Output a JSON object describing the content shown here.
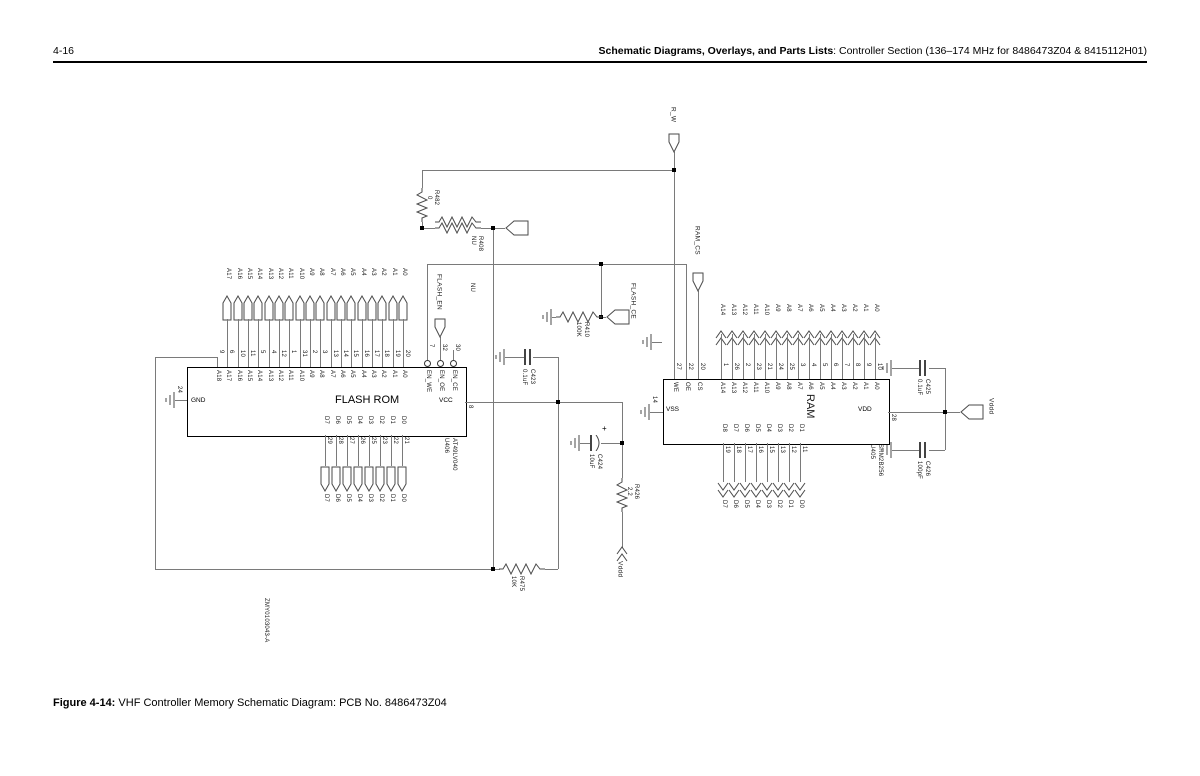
{
  "page": {
    "page_number": "4-16",
    "header_bold": "Schematic Diagrams, Overlays, and Parts Lists",
    "header_rest": ": Controller Section (136–174 MHz for 8486473Z04 & 8415112H01)",
    "figure_bold": "Figure 4-14:",
    "figure_rest": " VHF Controller Memory Schematic Diagram: PCB No. 8486473Z04",
    "drawing_number": "ZMY0103043-A"
  },
  "flash": {
    "name": "FLASH ROM",
    "refdes": "U406",
    "part": "AT49LV040",
    "gnd_label": "GND",
    "gnd_pin": "24",
    "vcc_label": "VCC",
    "vcc_pin": "8",
    "top_pins": [
      {
        "label": "A18",
        "number": "9"
      },
      {
        "label": "A17",
        "number": "6"
      },
      {
        "label": "A16",
        "number": "10"
      },
      {
        "label": "A15",
        "number": "11"
      },
      {
        "label": "A14",
        "number": "5"
      },
      {
        "label": "A13",
        "number": "4"
      },
      {
        "label": "A12",
        "number": "12"
      },
      {
        "label": "A11",
        "number": "1"
      },
      {
        "label": "A10",
        "number": "31"
      },
      {
        "label": "A9",
        "number": "2"
      },
      {
        "label": "A8",
        "number": "3"
      },
      {
        "label": "A7",
        "number": "13"
      },
      {
        "label": "A6",
        "number": "14"
      },
      {
        "label": "A5",
        "number": "15"
      },
      {
        "label": "A4",
        "number": "16"
      },
      {
        "label": "A3",
        "number": "17"
      },
      {
        "label": "A2",
        "number": "18"
      },
      {
        "label": "A1",
        "number": "19"
      },
      {
        "label": "A0",
        "number": "20"
      }
    ],
    "ctrl_pins": [
      {
        "label": "EN_WE",
        "number": "7"
      },
      {
        "label": "EN_OE",
        "number": "32"
      },
      {
        "label": "EN_CE",
        "number": "30"
      }
    ],
    "bottom_pins": [
      {
        "label": "D7",
        "number": "29"
      },
      {
        "label": "D6",
        "number": "28"
      },
      {
        "label": "D5",
        "number": "27"
      },
      {
        "label": "D4",
        "number": "26"
      },
      {
        "label": "D3",
        "number": "25"
      },
      {
        "label": "D2",
        "number": "23"
      },
      {
        "label": "D1",
        "number": "22"
      },
      {
        "label": "D0",
        "number": "21"
      }
    ]
  },
  "ram": {
    "name": "RAM",
    "refdes": "U405",
    "part": "SRM2B256",
    "vss_label": "VSS",
    "vss_pin": "14",
    "vdd_label": "VDD",
    "vdd_pin": "28",
    "top_pins": [
      {
        "label": "WE",
        "number": "27"
      },
      {
        "label": "OE",
        "number": "22"
      },
      {
        "label": "CS",
        "number": "20"
      },
      {
        "label": "A14",
        "number": "1"
      },
      {
        "label": "A13",
        "number": "26"
      },
      {
        "label": "A12",
        "number": "2"
      },
      {
        "label": "A11",
        "number": "23"
      },
      {
        "label": "A10",
        "number": "21"
      },
      {
        "label": "A9",
        "number": "24"
      },
      {
        "label": "A8",
        "number": "25"
      },
      {
        "label": "A7",
        "number": "3"
      },
      {
        "label": "A6",
        "number": "4"
      },
      {
        "label": "A5",
        "number": "5"
      },
      {
        "label": "A4",
        "number": "6"
      },
      {
        "label": "A3",
        "number": "7"
      },
      {
        "label": "A2",
        "number": "8"
      },
      {
        "label": "A1",
        "number": "9"
      },
      {
        "label": "A0",
        "number": "10"
      }
    ],
    "bottom_pins": [
      {
        "label": "D8",
        "number": "19",
        "out": "D7"
      },
      {
        "label": "D7",
        "number": "18",
        "out": "D6"
      },
      {
        "label": "D6",
        "number": "17",
        "out": "D5"
      },
      {
        "label": "D5",
        "number": "16",
        "out": "D4"
      },
      {
        "label": "D4",
        "number": "15",
        "out": "D3"
      },
      {
        "label": "D3",
        "number": "13",
        "out": "D2"
      },
      {
        "label": "D2",
        "number": "12",
        "out": "D1"
      },
      {
        "label": "D1",
        "number": "11",
        "out": "D0"
      }
    ]
  },
  "components": {
    "r482": {
      "name": "R482",
      "value": "0"
    },
    "r408": {
      "name": "R408",
      "value": "NU"
    },
    "r410": {
      "name": "R410",
      "value": "100K"
    },
    "r426": {
      "name": "R426",
      "value": "2.2"
    },
    "r475": {
      "name": "R475",
      "value": "10K"
    },
    "c423": {
      "name": "C423",
      "value": "0.1uF"
    },
    "c424": {
      "name": "C424",
      "value": "10uF",
      "polarity": "+"
    },
    "c425": {
      "name": "C425",
      "value": "0.1uF"
    },
    "c426": {
      "name": "C426",
      "value": "100pF"
    },
    "nu_note": "NU"
  },
  "signals": {
    "r_w": "R_W",
    "ram_cs": "RAM_CS",
    "flash_en": "FLASH_EN",
    "flash_ce": "FLASH_CE",
    "vddd_flash": "Vddd",
    "vddd_ram": "Vddd"
  }
}
